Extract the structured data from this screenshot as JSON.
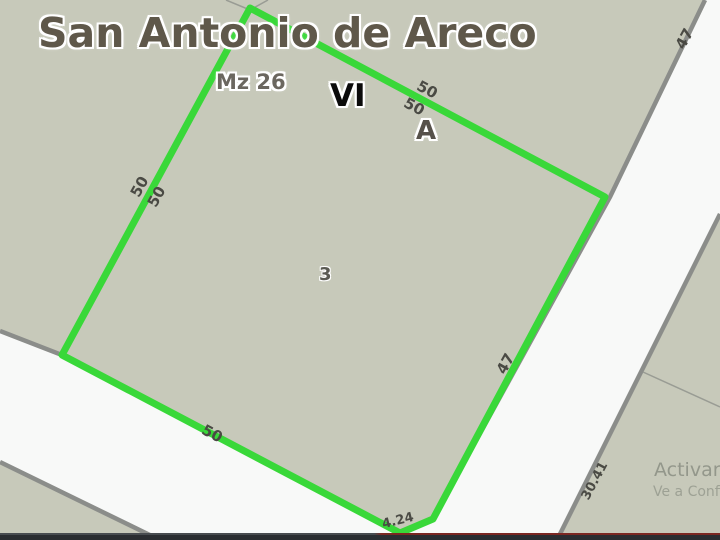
{
  "map": {
    "title": "San Antonio de Areco",
    "block_label": "Mz 26",
    "section_label": "VI",
    "zone_label": "A",
    "parcel_number": "3",
    "measurements": {
      "left_side_a": "50",
      "left_side_b": "50",
      "top_side_a": "50",
      "top_side_b": "50",
      "bottom_side": "50",
      "right_side": "47",
      "top_right_side": "47",
      "chamfer": "4.24",
      "neighbor_side": "30.41"
    },
    "colors": {
      "background": "#C7C9BA",
      "road_fill": "#F8F9F8",
      "road_edge": "#8B8D8A",
      "thin_line": "#999C94",
      "parcel_highlight": "#39D839",
      "title_color": "#5F584A"
    }
  },
  "watermark": {
    "line1": "Activar",
    "line2": "Ve a Confi"
  }
}
